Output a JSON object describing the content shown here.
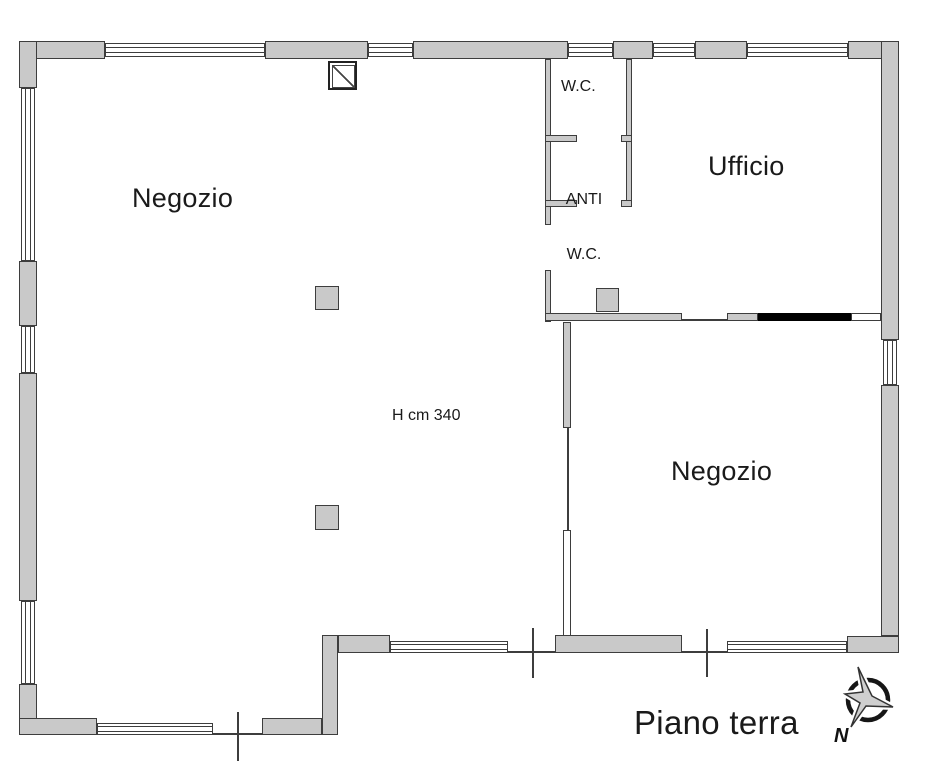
{
  "rooms": {
    "negozio_left": "Negozio",
    "wc": "W.C.",
    "anti_wc": {
      "line1": "ANTI",
      "line2": "W.C."
    },
    "ufficio": "Ufficio",
    "negozio_right": "Negozio"
  },
  "annotations": {
    "ceiling_height": "H cm 340",
    "floor_label": "Piano terra",
    "compass_north": "N"
  },
  "colors": {
    "wall_fill": "#c9c9c9",
    "wall_line": "#3d3d3d",
    "door_panel_black": "#000000",
    "background": "#ffffff",
    "text": "#1a1a1a"
  }
}
